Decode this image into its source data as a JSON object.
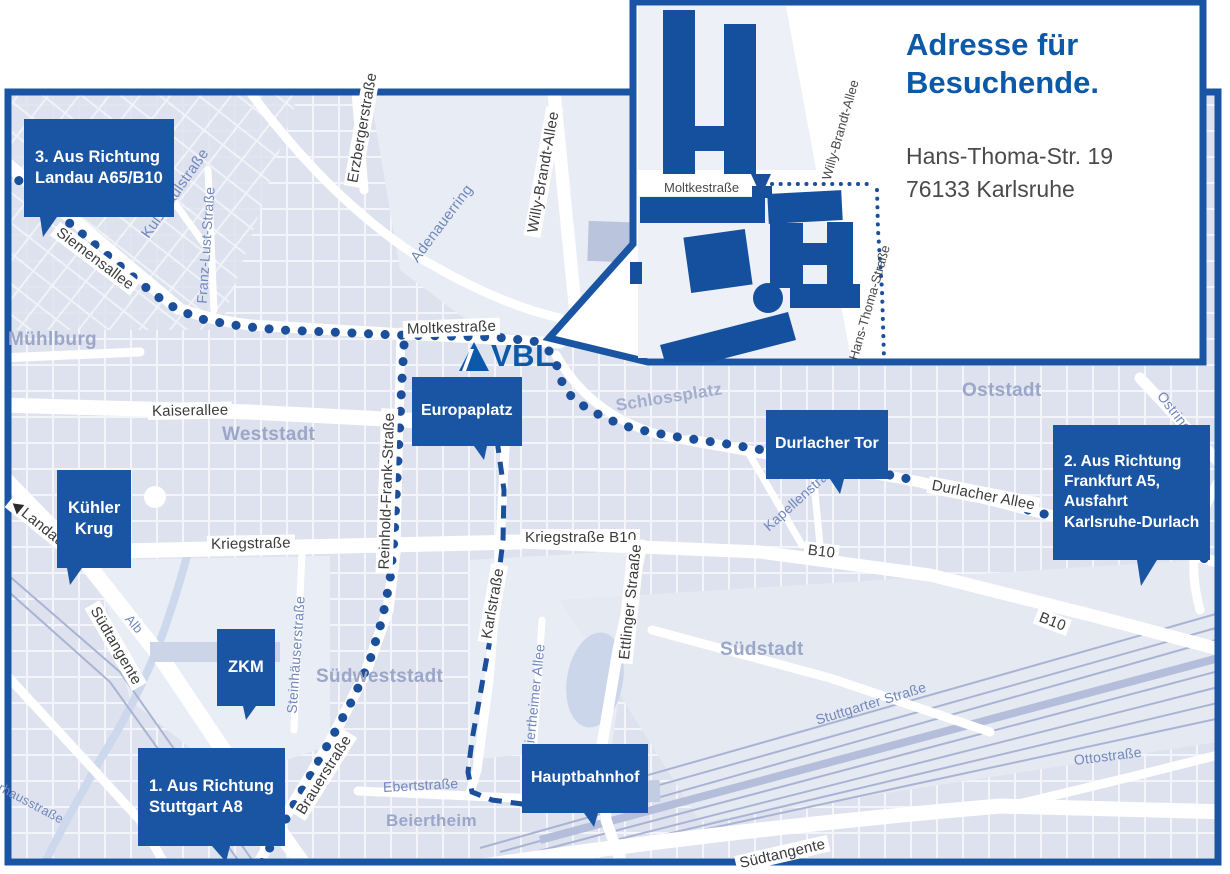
{
  "map": {
    "colors": {
      "primary_blue": "#1a55a3",
      "route_blue": "#1b4f9c",
      "title_blue": "#0d59a9"
    },
    "logo": {
      "text": "VBL"
    },
    "callouts": {
      "landau": {
        "label": "3. Aus Richtung\nLandau A65/B10"
      },
      "kuehler_krug": {
        "label": "Kühler\nKrug"
      },
      "zkm": {
        "label": "ZKM"
      },
      "stuttgart": {
        "label": "1. Aus Richtung\nStuttgart A8"
      },
      "europaplatz": {
        "label": "Europaplatz"
      },
      "durlacher_tor": {
        "label": "Durlacher Tor"
      },
      "frankfurt": {
        "label": "2. Aus Richtung\nFrankfurt A5,\nAusfahrt\nKarlsruhe-Durlach"
      },
      "hauptbahnhof": {
        "label": "Hauptbahnhof"
      }
    },
    "streets": {
      "siemensallee": "Siemensallee",
      "kussmaulstrasse": "Kußmaulstraße",
      "franz_lust_strasse": "Franz-Lust-Straße",
      "erzbergerstrasse": "Erzbergerstraße",
      "adenauerring": "Adenauerring",
      "willy_brandt_allee": "Willy-Brandt-Allee",
      "moltkestrasse": "Moltkestraße",
      "kaiserallee": "Kaiserallee",
      "reinhold_frank_strasse": "Reinhold-Frank-Straße",
      "kriegstrasse": "Kriegstraße",
      "kriegstrasse_b10": "Kriegstraße B10",
      "landau_b10": "Landau B10",
      "karlstrasse": "Karlstraße",
      "ettlinger_strasse": "Ettlinger Straaße",
      "steinhaeuserstrasse": "Steinhäuserstraße",
      "brauerstrasse": "Brauerstraße",
      "ebertstrasse": "Ebertstraße",
      "beiertheimer_allee": "Beiertheimer Allee",
      "kapellenstrasse": "Kapellenstraße",
      "durlacher_allee": "Durlacher Allee",
      "b10_west": "B10",
      "b10_ost": "B10",
      "ostring_nord": "Ostring",
      "ostring_sued": "Ostring",
      "stuttgarter_strasse": "Stuttgarter Straße",
      "ottostrasse": "Ottostraße",
      "alb": "Alb",
      "pulverhausstrasse": "Pulverhausstraße",
      "suedtangente_west": "Südtangente",
      "suedtangente_sued": "Südtangente"
    },
    "places": {
      "muehlburg": "Mühlburg",
      "weststadt": "Weststadt",
      "oststadt": "Oststadt",
      "suedstadt": "Südstadt",
      "suedweststadt": "Südweststadt",
      "beiertheim": "Beiertheim",
      "schlossplatz": "Schlossplatz"
    }
  },
  "inset": {
    "title": "Adresse für\nBesuchende.",
    "address": "Hans-Thoma-Str. 19\n76133 Karlsruhe",
    "streets": {
      "moltkestrasse": "Moltkestraße",
      "willy_brandt_allee": "Willy-Brandt-Allee",
      "hans_thoma_strasse": "Hans-Thoma-Straße"
    }
  }
}
